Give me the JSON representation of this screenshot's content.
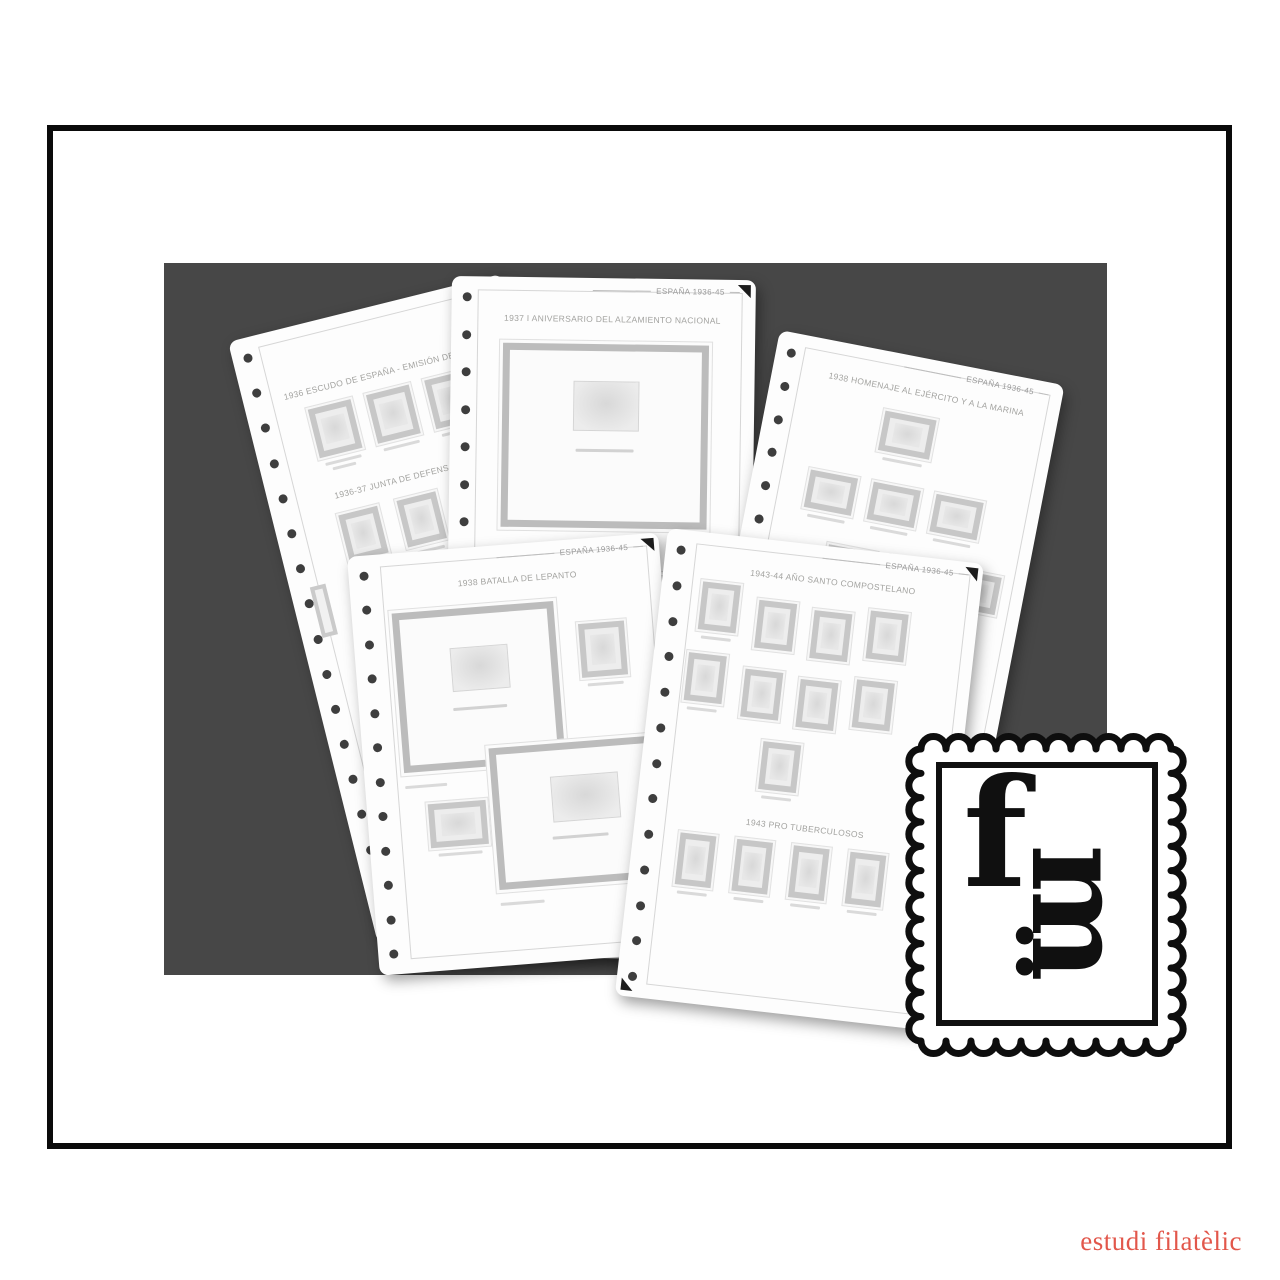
{
  "branding": {
    "logo": {
      "letter_f": "f",
      "colon": ":",
      "letter_m": "m"
    },
    "watermark": "estudi filatèlic"
  },
  "pages": {
    "back_left": {
      "title_1": "1936 ESCUDO DE ESPAÑA - EMISIÓN DE GRANADA",
      "title_2": "1936-37 JUNTA DE DEFENSA NACIONAL"
    },
    "back_center": {
      "header": "ESPAÑA 1936-45",
      "title_1": "1937 I ANIVERSARIO DEL ALZAMIENTO NACIONAL"
    },
    "back_right": {
      "header": "ESPAÑA 1936-45",
      "title_1": "1938 HOMENAJE AL EJÉRCITO Y A LA MARINA"
    },
    "front_left": {
      "header": "ESPAÑA 1936-45",
      "title_1": "1938 BATALLA DE LEPANTO"
    },
    "front_right": {
      "header": "ESPAÑA 1936-45",
      "title_1": "1943-44 AÑO SANTO COMPOSTELANO",
      "title_2": "1943 PRO TUBERCULOSOS"
    }
  },
  "colors": {
    "backdrop": "#474747",
    "frame": "#0a0a0a",
    "watermark": "#e2574b"
  }
}
